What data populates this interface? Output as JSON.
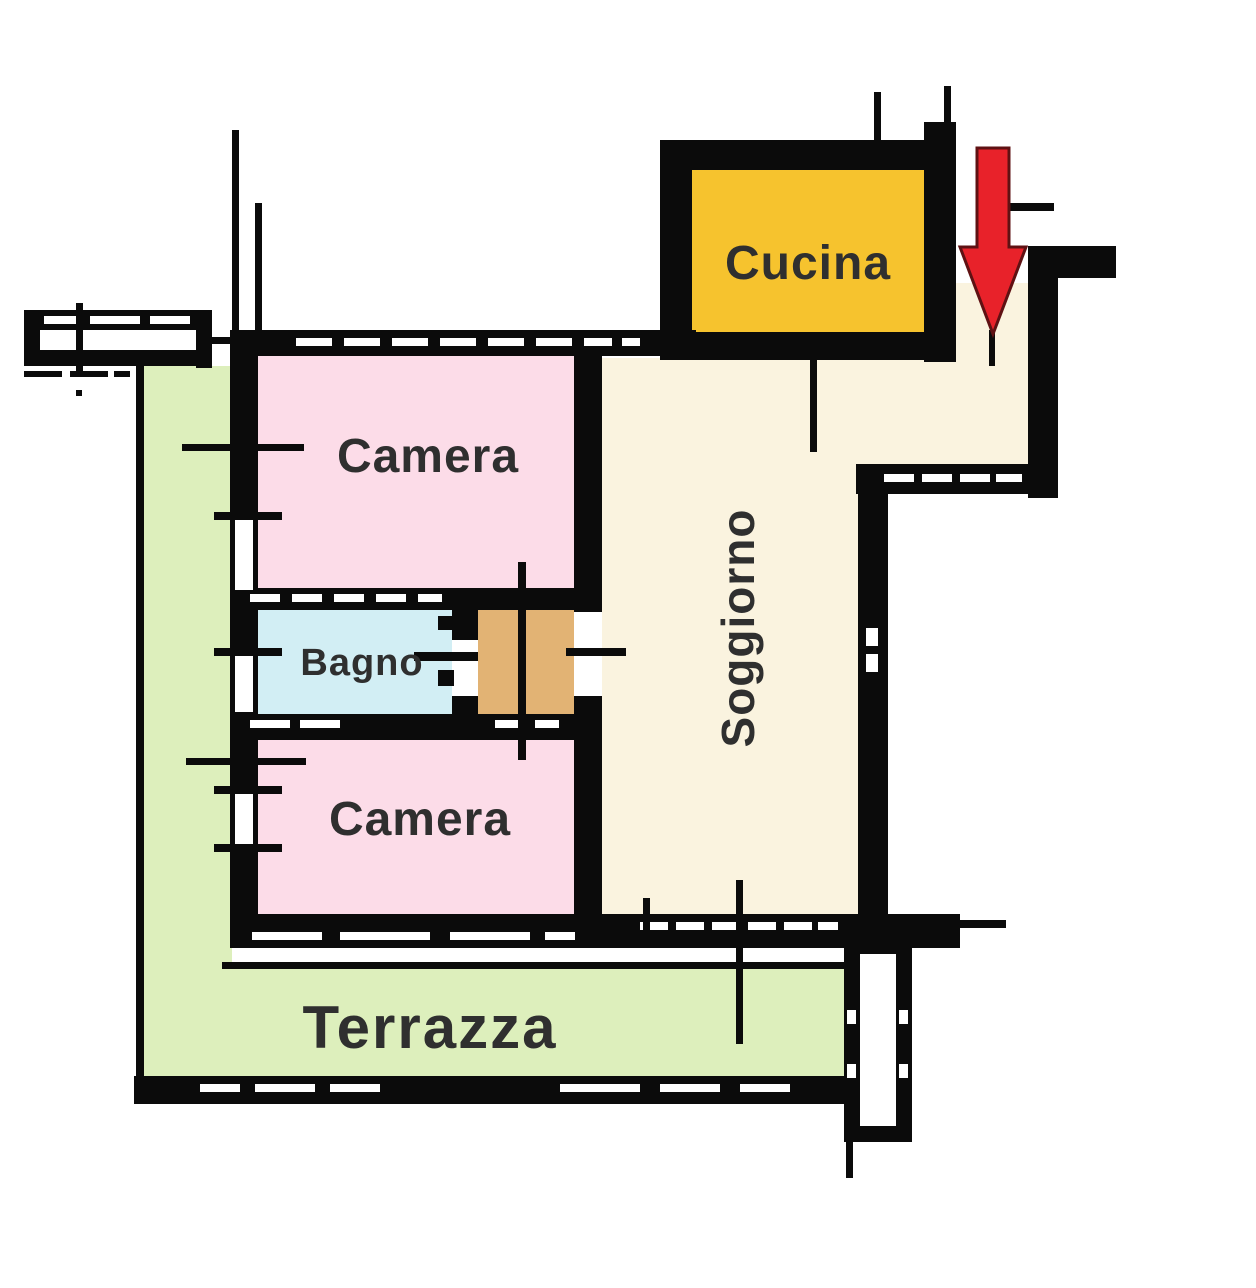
{
  "plan": {
    "type": "apartment-floor-plan",
    "rooms": {
      "cucina": {
        "label": "Cucina",
        "color": "#f6c32e"
      },
      "soggiorno": {
        "label": "Soggiorno",
        "color": "#faf3df"
      },
      "camera_nord": {
        "label": "Camera",
        "color": "#fcdce8"
      },
      "bagno": {
        "label": "Bagno",
        "color": "#d2eef4"
      },
      "camera_sud": {
        "label": "Camera",
        "color": "#fcdce8"
      },
      "terrazza": {
        "label": "Terrazza",
        "color": "#ddefbc"
      },
      "disimpegno": {
        "color": "#e2b374"
      }
    },
    "entrance_arrow": {
      "fill": "#e8222a",
      "outline": "#5f1113"
    },
    "wall_color": "#0b0b0b",
    "label_color": "#2f2f2f",
    "background": "#ffffff"
  }
}
